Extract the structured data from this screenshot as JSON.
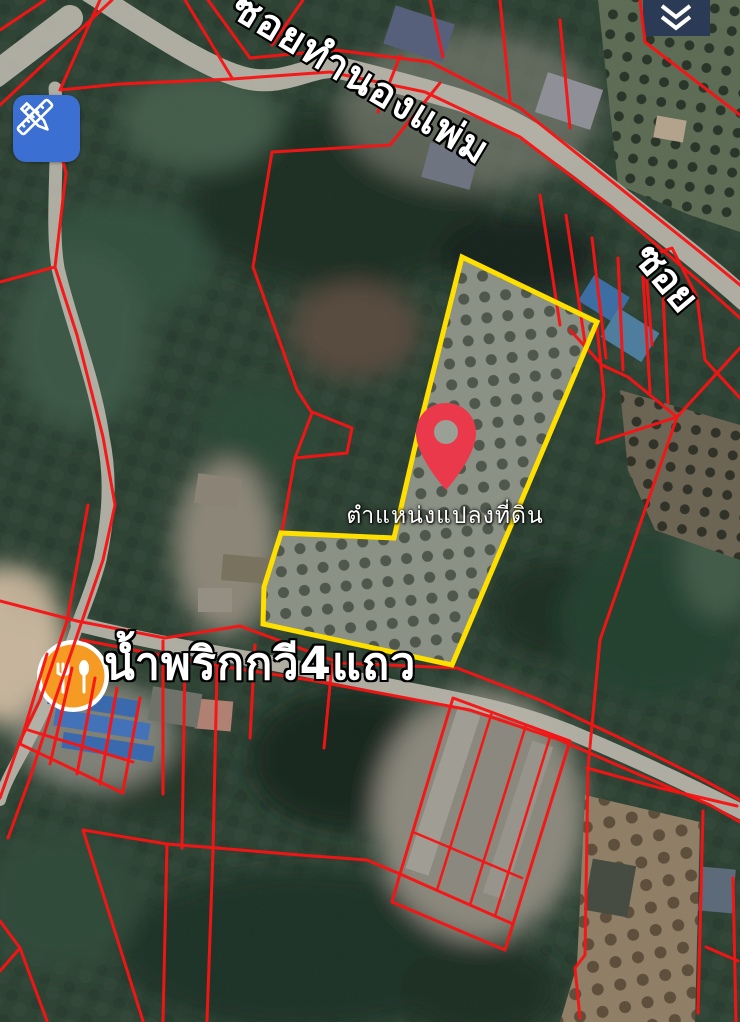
{
  "map": {
    "street_label_top": "ซอยทำนองแพ่ม",
    "street_label_right": "ซอย",
    "pin_caption": "ตำแหน่งแปลงที่ดิน",
    "poi_label": "น้ำพริกกวี4แถว",
    "colors": {
      "cadastral_line": "#f81414",
      "highlight_outline": "#ffdf00",
      "pin": "#e9394a",
      "poi_circle": "#f59a23",
      "edit_button": "#3b6fd2",
      "road": "#b6b3a8"
    }
  }
}
